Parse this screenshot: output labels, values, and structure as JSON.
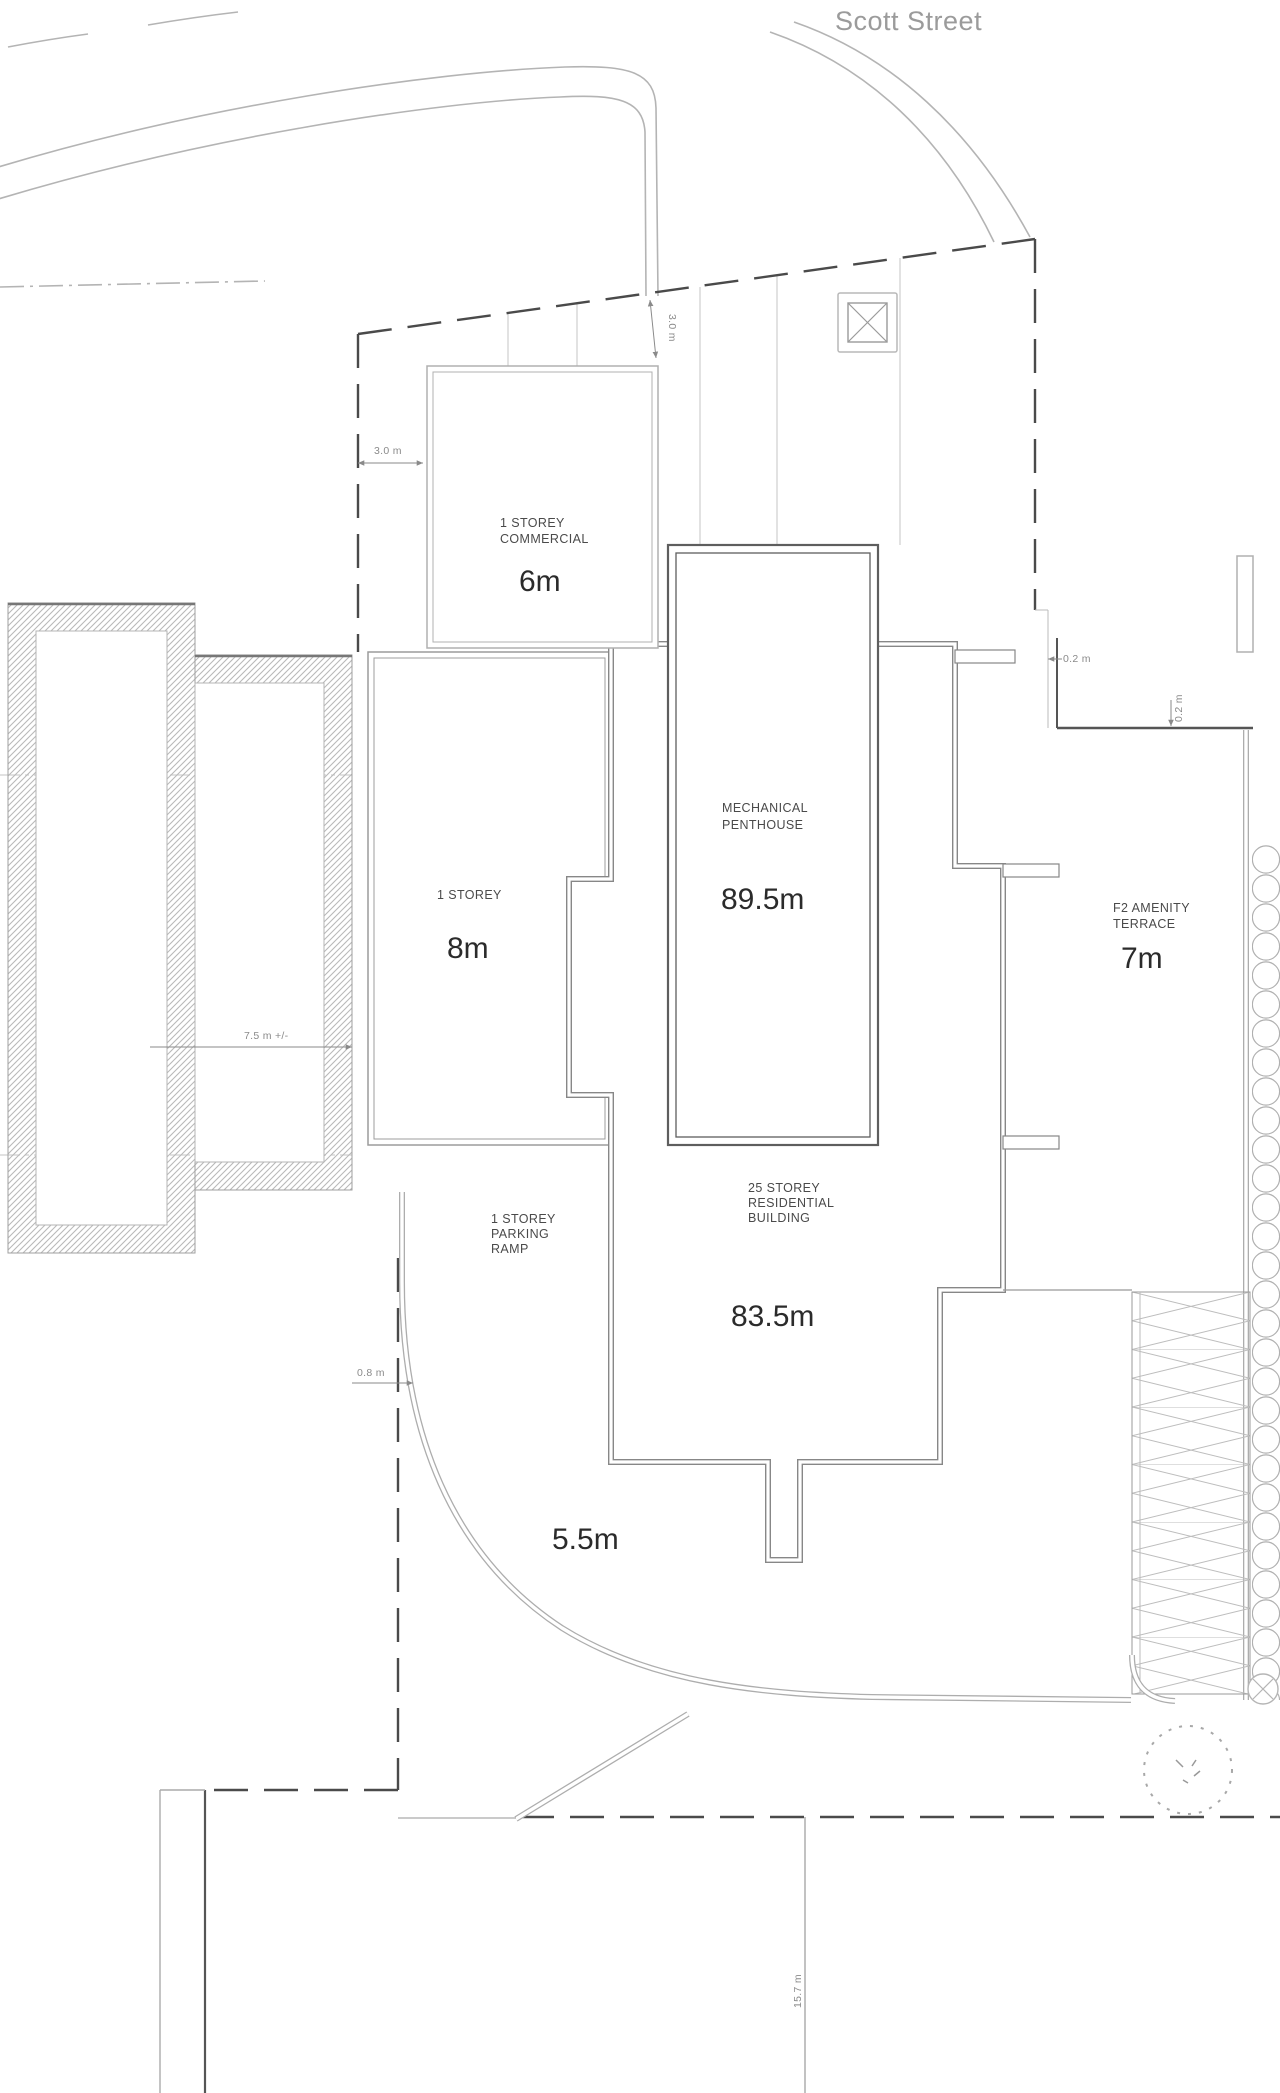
{
  "plan": {
    "street_name": "Scott Street",
    "buildings": {
      "commercial": {
        "line1": "1 STOREY",
        "line2": "COMMERCIAL",
        "height": "6m"
      },
      "one_storey_west": {
        "line1": "1 STOREY",
        "height": "8m"
      },
      "mechanical_penthouse": {
        "line1": "MECHANICAL",
        "line2": "PENTHOUSE",
        "height": "89.5m"
      },
      "residential_tower": {
        "line1": "25 STOREY",
        "line2": "RESIDENTIAL",
        "line3": "BUILDING",
        "height": "83.5m"
      },
      "parking_ramp": {
        "line1": "1 STOREY",
        "line2": "PARKING",
        "line3": "RAMP",
        "height": "5.5m"
      },
      "amenity_terrace": {
        "line1": "F2 AMENITY",
        "line2": "TERRACE",
        "height": "7m"
      }
    },
    "dimensions": {
      "north_setback_left": "3.0 m",
      "north_setback_diagonal": "3.0 m",
      "east_setback": "0.2 m",
      "east_setback_vertical": "0.2 m",
      "west_building_width": "7.5 m +/-",
      "west_setback": "0.8 m",
      "south_depth": "15.7 m"
    },
    "colors": {
      "background": "#ffffff",
      "line_light": "#b0b0b0",
      "line_medium": "#8a8a8a",
      "line_dark": "#555555",
      "boundary": "#4a4a4a",
      "text_dark": "#2b2b2b",
      "text_muted": "#8a8a8a"
    }
  }
}
